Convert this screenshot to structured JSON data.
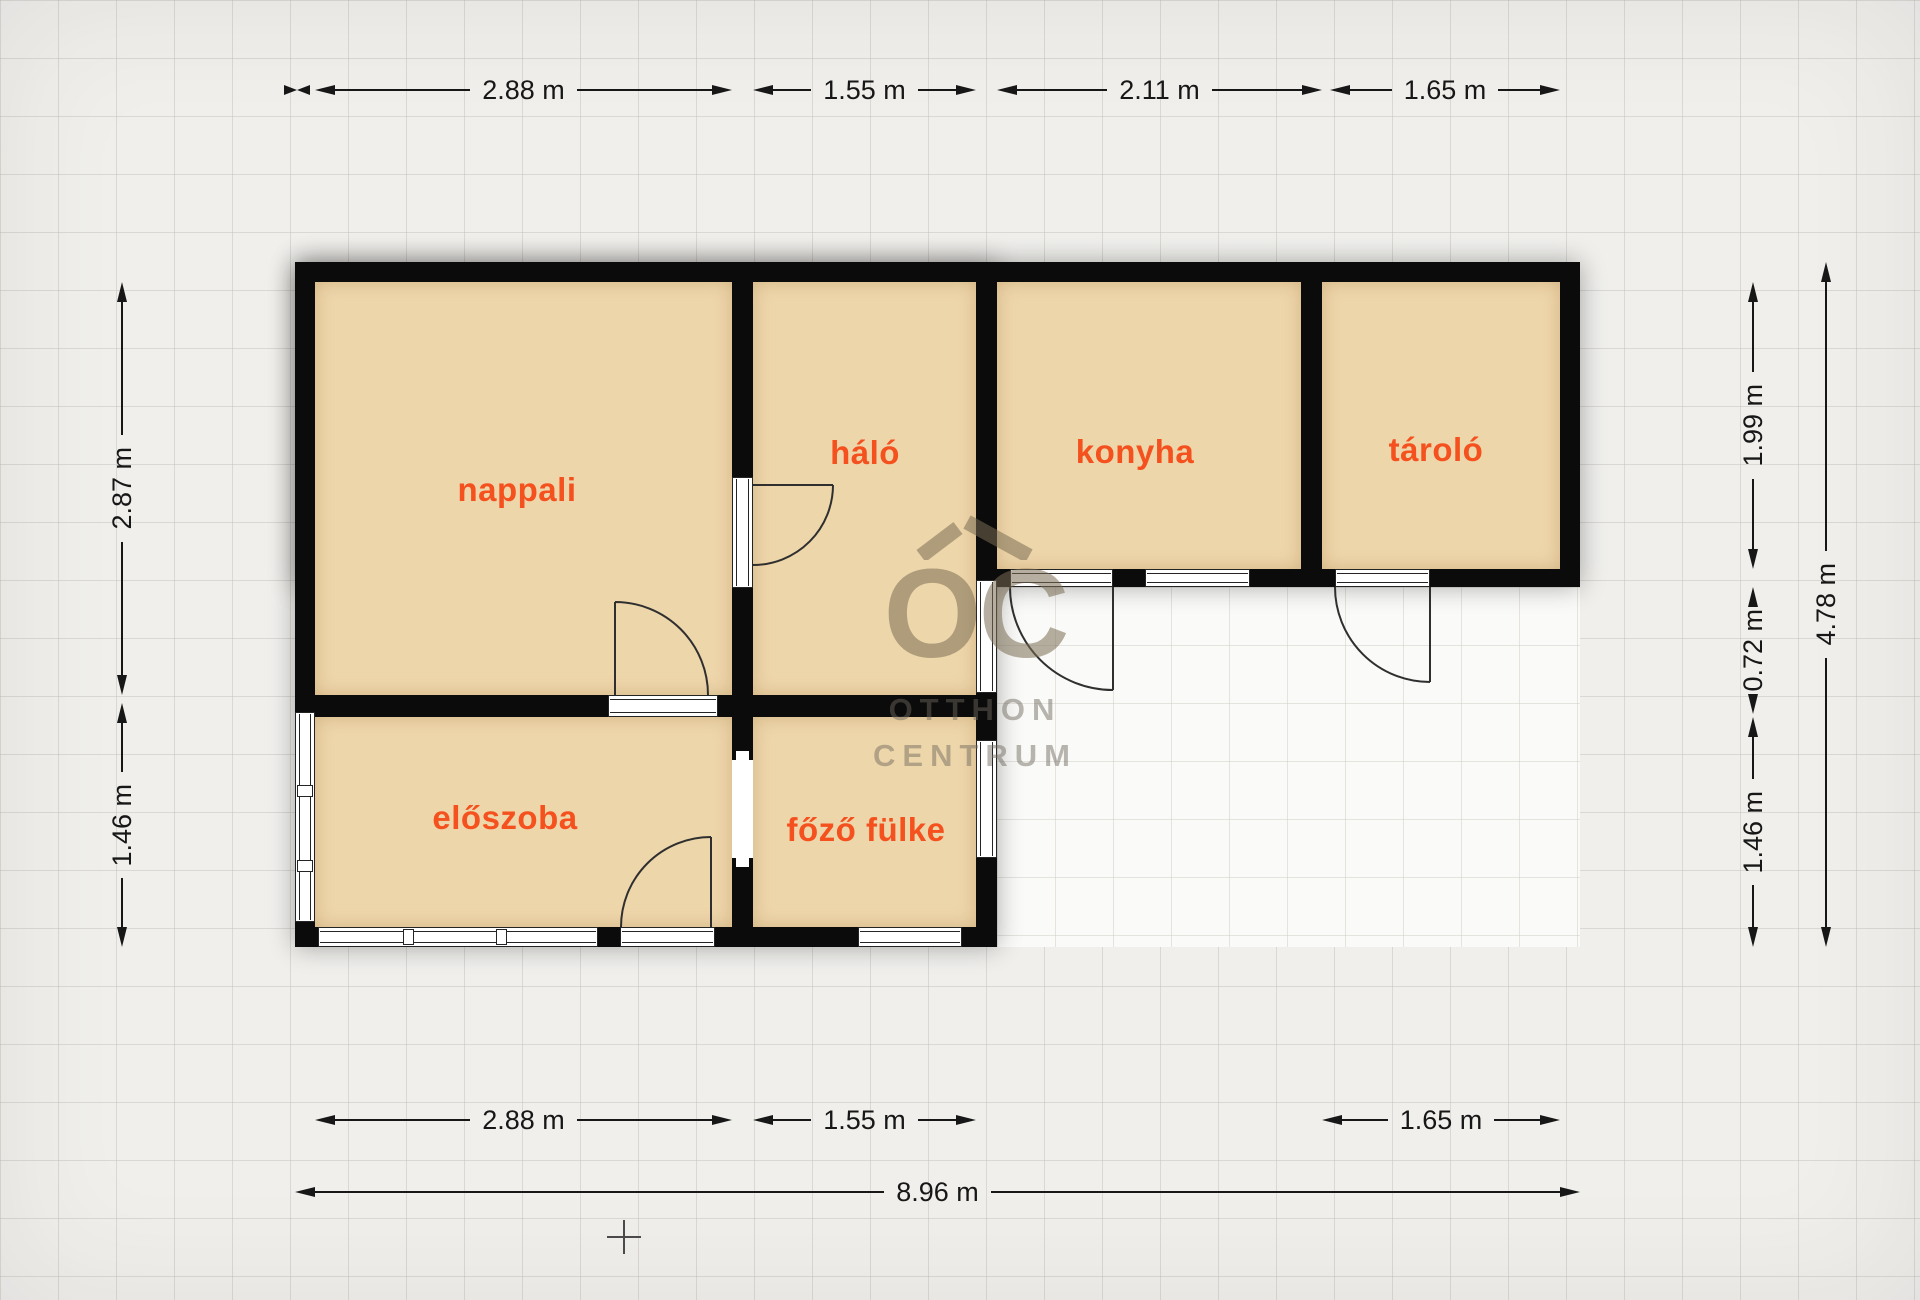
{
  "plan": {
    "rooms": [
      {
        "id": "nappali",
        "label": "nappali"
      },
      {
        "id": "halo",
        "label": "háló"
      },
      {
        "id": "konyha",
        "label": "konyha"
      },
      {
        "id": "tarolo",
        "label": "tároló"
      },
      {
        "id": "eloszoba",
        "label": "előszoba"
      },
      {
        "id": "fozo-fulke",
        "label": "főző fülke"
      }
    ],
    "dimensions": {
      "top": [
        {
          "label": "2.88 m"
        },
        {
          "label": "1.55 m"
        },
        {
          "label": "2.11 m"
        },
        {
          "label": "1.65 m"
        }
      ],
      "bottom": [
        {
          "label": "2.88 m"
        },
        {
          "label": "1.55 m"
        },
        {
          "label": "1.65 m"
        }
      ],
      "bottom_total": {
        "label": "8.96 m"
      },
      "left": [
        {
          "label": "2.87 m"
        },
        {
          "label": "1.46 m"
        }
      ],
      "right": [
        {
          "label": "1.99 m"
        },
        {
          "label": "0.72 m"
        },
        {
          "label": "1.46 m"
        }
      ],
      "right_total": {
        "label": "4.78 m"
      }
    },
    "watermark": {
      "logo": "OC",
      "line1": "OTTHON",
      "line2": "CENTRUM"
    },
    "colors": {
      "accent": "#f4511e",
      "wall": "#0b0b0b",
      "room_fill": "#eed6ab",
      "watermark": "#b3a78c"
    }
  }
}
